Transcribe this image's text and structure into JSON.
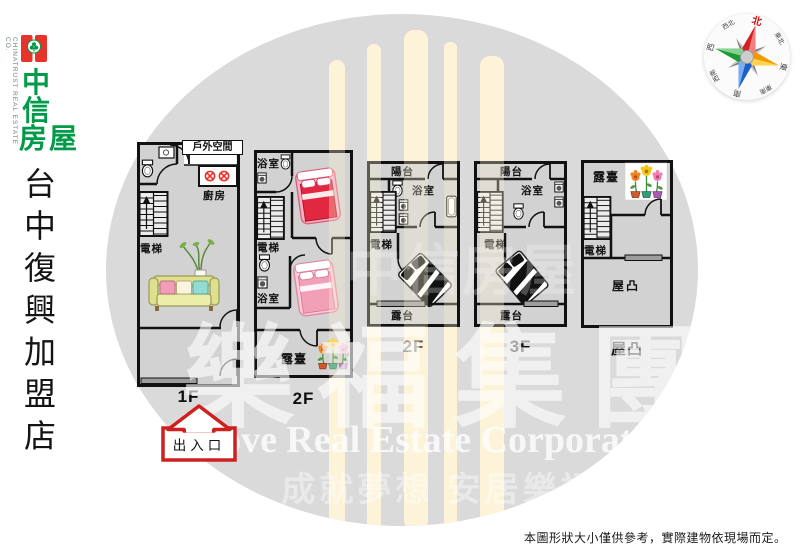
{
  "colors": {
    "brand_green": "#009a49",
    "brand_red": "#e8332a",
    "arrow_red": "#cf2020",
    "compass_north": "#cc1111",
    "floor_fill": "#d2d2d2",
    "stripe_cream": "#fdf3d8",
    "circle_gray": "#dadada"
  },
  "brand": {
    "company_vertical_en": "CHINATRUST REAL ESTATE CO.",
    "logo": {
      "c1": "中",
      "c2": "信",
      "c34": "房屋"
    },
    "store_name": "台中復興加盟店"
  },
  "compass": {
    "north": "北",
    "northeast": "東北",
    "east": "東",
    "southeast": "東南",
    "south": "南",
    "southwest": "西南",
    "west": "西",
    "northwest": "西北"
  },
  "floorplans": [
    {
      "floor": "1F",
      "outdoor": "戶外空間",
      "kitchen": "廚房",
      "elevator": "電梯"
    },
    {
      "floor": "2F",
      "bath_top": "浴室",
      "elevator": "電梯",
      "bath_bottom": "浴室",
      "terrace": "露臺"
    },
    {
      "floor": "2F",
      "balcony": "陽台",
      "bath": "浴室",
      "elevator": "電梯",
      "terrace": "露台"
    },
    {
      "floor": "3F",
      "balcony": "陽台",
      "bath": "浴室",
      "elevator": "電梯",
      "terrace": "露台"
    },
    {
      "floor": "屋凸",
      "terrace": "露臺",
      "elevator": "電梯",
      "room": "屋凸"
    }
  ],
  "entrance": {
    "label": "出入口"
  },
  "watermark": {
    "group_name": "樂福集團",
    "group_name_en": "Love Real Estate Corporation",
    "slogan": "成就夢想 安居樂福",
    "brand_faint": "中信房屋"
  },
  "disclaimer": "本圖形狀大小僅供參考，實際建物依現場而定。"
}
